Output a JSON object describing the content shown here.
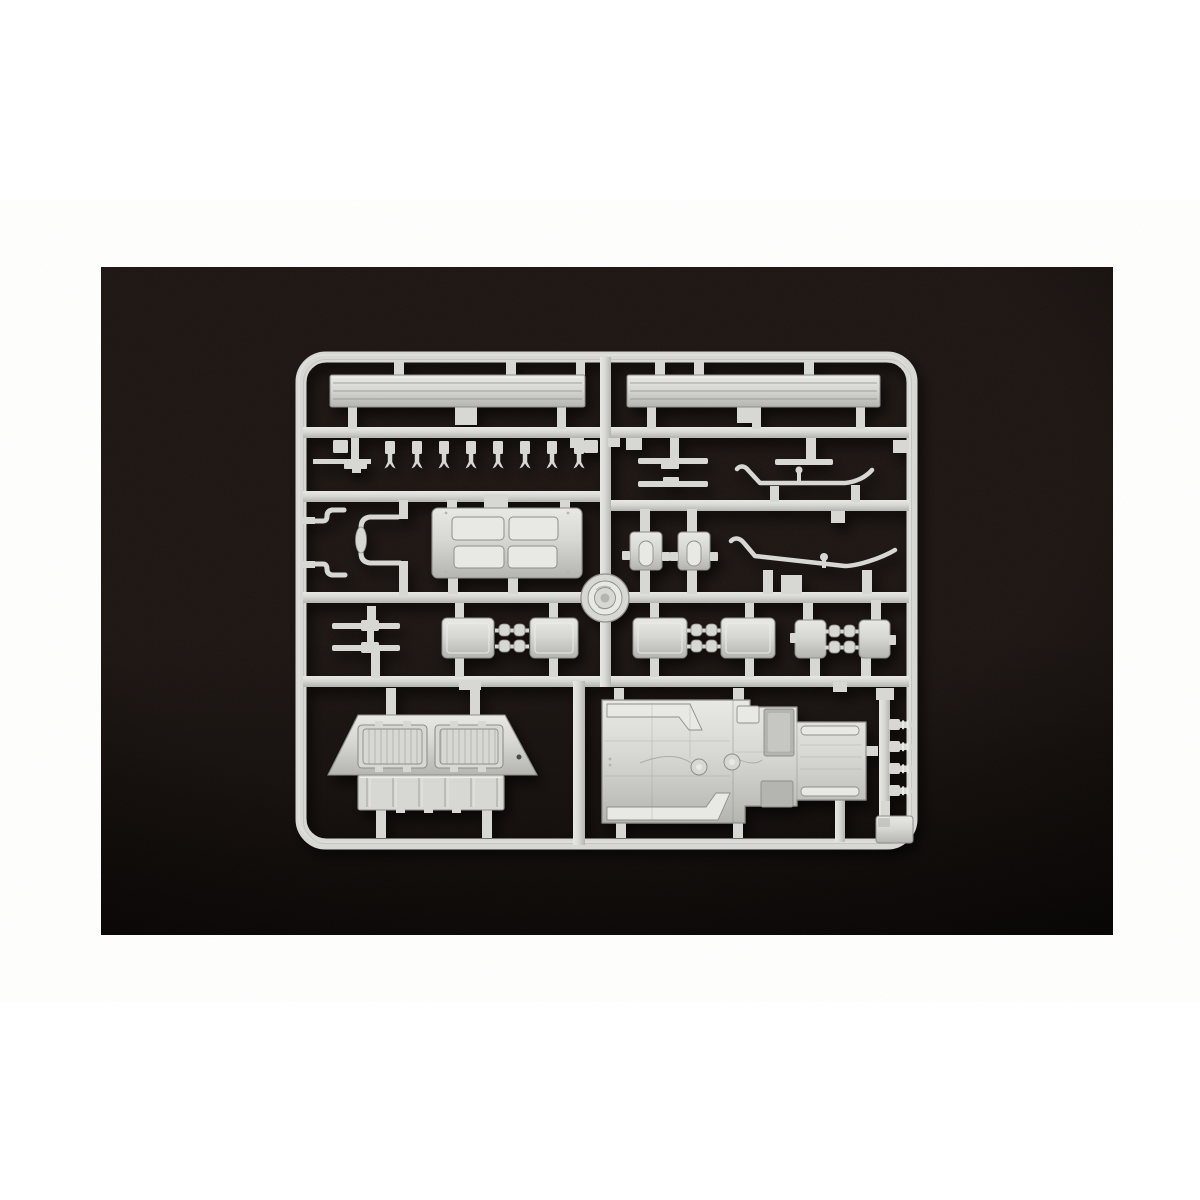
{
  "image": {
    "type": "photograph",
    "caption": "Light grey injection-moulded model kit sprue photographed on dark black fabric, centered in a white page",
    "alt": "Model kit sprue (parts frame) holding moulded parts: two long grooved planks, a row of eight small pins, axle rods, two anti-roll bars, a four-hatch engine deck panel, tow-hook assembly, a road wheel, slotted boxes, three pairs of linked suspension plates, a louvered rear deck, a large hull floor pan, four ribbed pegs and a corner pad"
  },
  "colors": {
    "page_bg": "#ffffff",
    "photo_bg": "#1c1512",
    "photo_bg_edge": "#090605",
    "plastic": "#d7d7d3",
    "plastic_light": "#e8e8e5",
    "plastic_dark": "#b4b4b0",
    "plastic_line": "#8e8e8a"
  },
  "parts": [
    {
      "name": "grooved-plank",
      "qty": 2
    },
    {
      "name": "small-pin",
      "qty": 8
    },
    {
      "name": "axle-rod",
      "qty": 5
    },
    {
      "name": "tow-hook-assembly",
      "qty": 1
    },
    {
      "name": "engine-deck-hatch-panel",
      "qty": 1
    },
    {
      "name": "road-wheel",
      "qty": 1
    },
    {
      "name": "anti-roll-bar",
      "qty": 2
    },
    {
      "name": "slotted-box",
      "qty": 2
    },
    {
      "name": "linked-suspension-plates",
      "qty": 3
    },
    {
      "name": "louvered-rear-deck",
      "qty": 1
    },
    {
      "name": "hull-floor-pan",
      "qty": 1
    },
    {
      "name": "ribbed-peg",
      "qty": 4
    },
    {
      "name": "corner-pad",
      "qty": 1
    }
  ]
}
